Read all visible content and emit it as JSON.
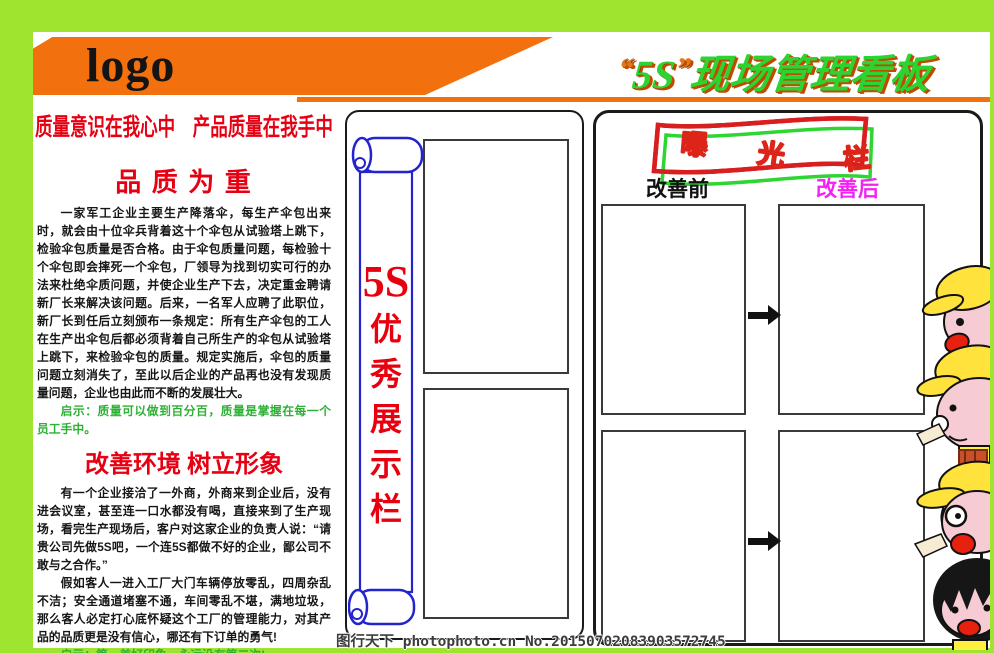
{
  "header": {
    "logo": "logo",
    "title": {
      "open_quote": "“",
      "code": "5S",
      "close_quote": "”",
      "rest": "现场管理看板"
    },
    "slogan": "质量意识在我心中　产品质量在我手中"
  },
  "left_column": {
    "story1": {
      "heading": "品 质 为 重",
      "body": "一家军工企业主要生产降落伞，每生产伞包出来时，就会由十位伞兵背着这十个伞包从试验塔上跳下，检验伞包质量是否合格。由于伞包质量问题，每检验十个伞包即会摔死一个伞包，厂领导为找到切实可行的办法来杜绝伞质问题，并使企业生产下去，决定重金聘请新厂长来解决该问题。后来，一名军人应聘了此职位，新厂长到任后立刻颁布一条规定：所有生产伞包的工人在生产出伞包后都必须背着自己所生产的伞包从试验塔上跳下，来检验伞包的质量。规定实施后，伞包的质量问题立刻消失了，至此以后企业的产品再也没有发现质量问题，企业也由此而不断的发展壮大。",
      "tip": "启示：质量可以做到百分百，质量是掌握在每一个员工手中。"
    },
    "story2": {
      "heading": "改善环境 树立形象",
      "body1": "有一个企业接洽了一外商，外商来到企业后，没有进会议室，甚至连一口水都没有喝，直接来到了生产现场，看完生产现场后，客户对这家企业的负责人说：“请贵公司先做5S吧，一个连5S都做不好的企业，鄙公司不敢与之合作。”",
      "body2": "假如客人一进入工厂大门车辆停放零乱，四周杂乱不洁；安全通道堵塞不通，车间零乱不堪，满地垃圾，那么客人必定打心底怀疑这个工厂的管理能力，对其产品的品质更是没有信心，哪还有下订单的勇气!",
      "tip": "启示：第一美好印象，永远没有第二次!"
    }
  },
  "center_panel": {
    "scroll_chars": [
      "5S",
      "优",
      "秀",
      "展",
      "示",
      "栏"
    ]
  },
  "right_panel": {
    "banner_chars": [
      "曝",
      "光",
      "栏"
    ],
    "before_label": "改善前",
    "after_label": "改善后"
  },
  "watermark": "图行天下 photophoto.cn  No.20150702083903572745",
  "colors": {
    "background_green": "#9FE42F",
    "accent_orange": "#F3700E",
    "headline_red": "#E60012",
    "tip_green": "#2DB135",
    "after_magenta": "#F321F3",
    "scroll_blue": "#2424CE",
    "title_green": "#2DD330",
    "cap_yellow": "#FFE23C",
    "face_pink": "#F7CBD4"
  }
}
